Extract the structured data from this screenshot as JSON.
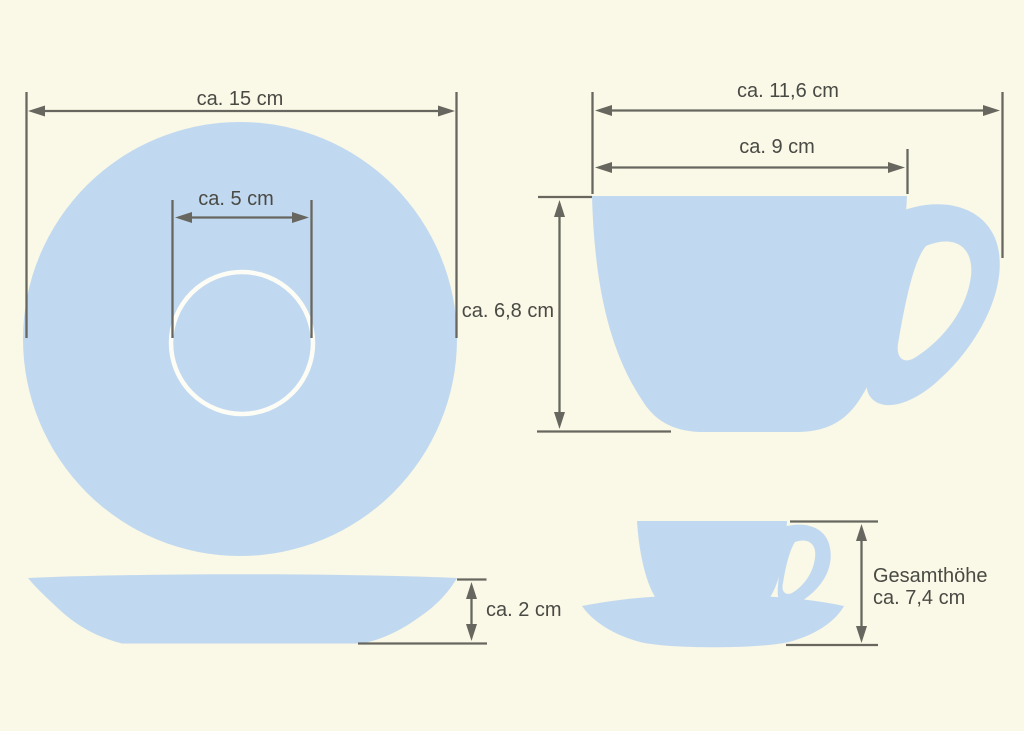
{
  "colors": {
    "background": "#FAF8E6",
    "porcelain_blue": "#C1D9F0",
    "dimension_line": "#67675F",
    "label_text": "#4A4A45",
    "well_ring_white": "#FDFDF6"
  },
  "figures": {
    "saucer_top_view": {
      "outer_diameter_label": "ca. 15 cm",
      "well_diameter_label": "ca. 5 cm"
    },
    "cup_side_view": {
      "overall_width_label": "ca. 11,6 cm",
      "rim_diameter_label": "ca. 9 cm",
      "height_label": "ca. 6,8 cm"
    },
    "saucer_side_view": {
      "height_label": "ca. 2 cm"
    },
    "cup_with_saucer_view": {
      "total_height_label": "Gesamthöhe",
      "total_height_value": "ca. 7,4 cm"
    }
  }
}
